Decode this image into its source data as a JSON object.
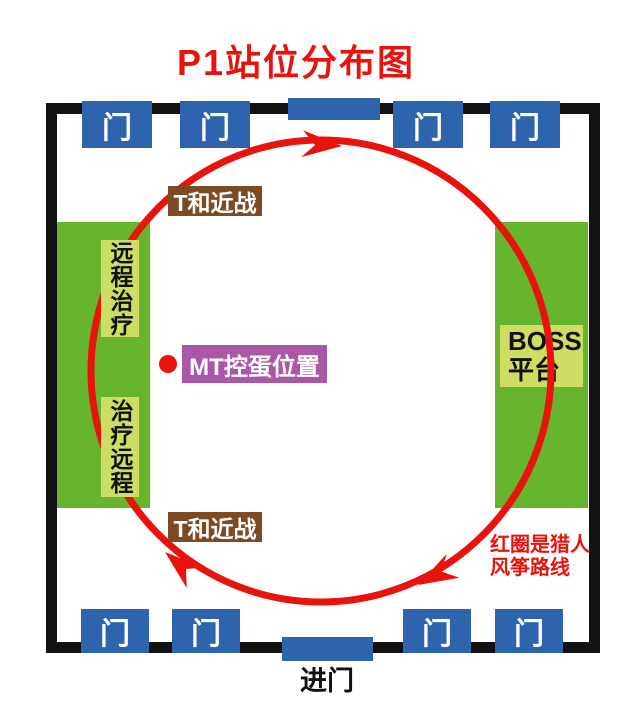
{
  "title": "P1站位分布图",
  "doors": {
    "top": [
      "门",
      "门",
      "门",
      "门"
    ],
    "bottom": [
      "门",
      "门",
      "门",
      "门"
    ]
  },
  "entry_label": "进门",
  "zones": {
    "left": {
      "top_label": "远程治疗",
      "bottom_label": "治疗远程"
    },
    "right": {
      "line1": "BOSS",
      "line2": "平台"
    }
  },
  "melee": {
    "top": "T和近战",
    "bottom": "T和近战"
  },
  "mt": {
    "label": "MT控蛋位置"
  },
  "route_note": {
    "line1": "红圈是猎人",
    "line2": "风筝路线"
  },
  "colors": {
    "title_red": "#e8130d",
    "route_red": "#e8130d",
    "door_blue": "#2e63ad",
    "zone_green": "#67b42e",
    "label_light_green": "#cede65",
    "melee_brown": "#7c4a23",
    "mt_purple": "#ab57a8",
    "wall_black": "#121212"
  }
}
